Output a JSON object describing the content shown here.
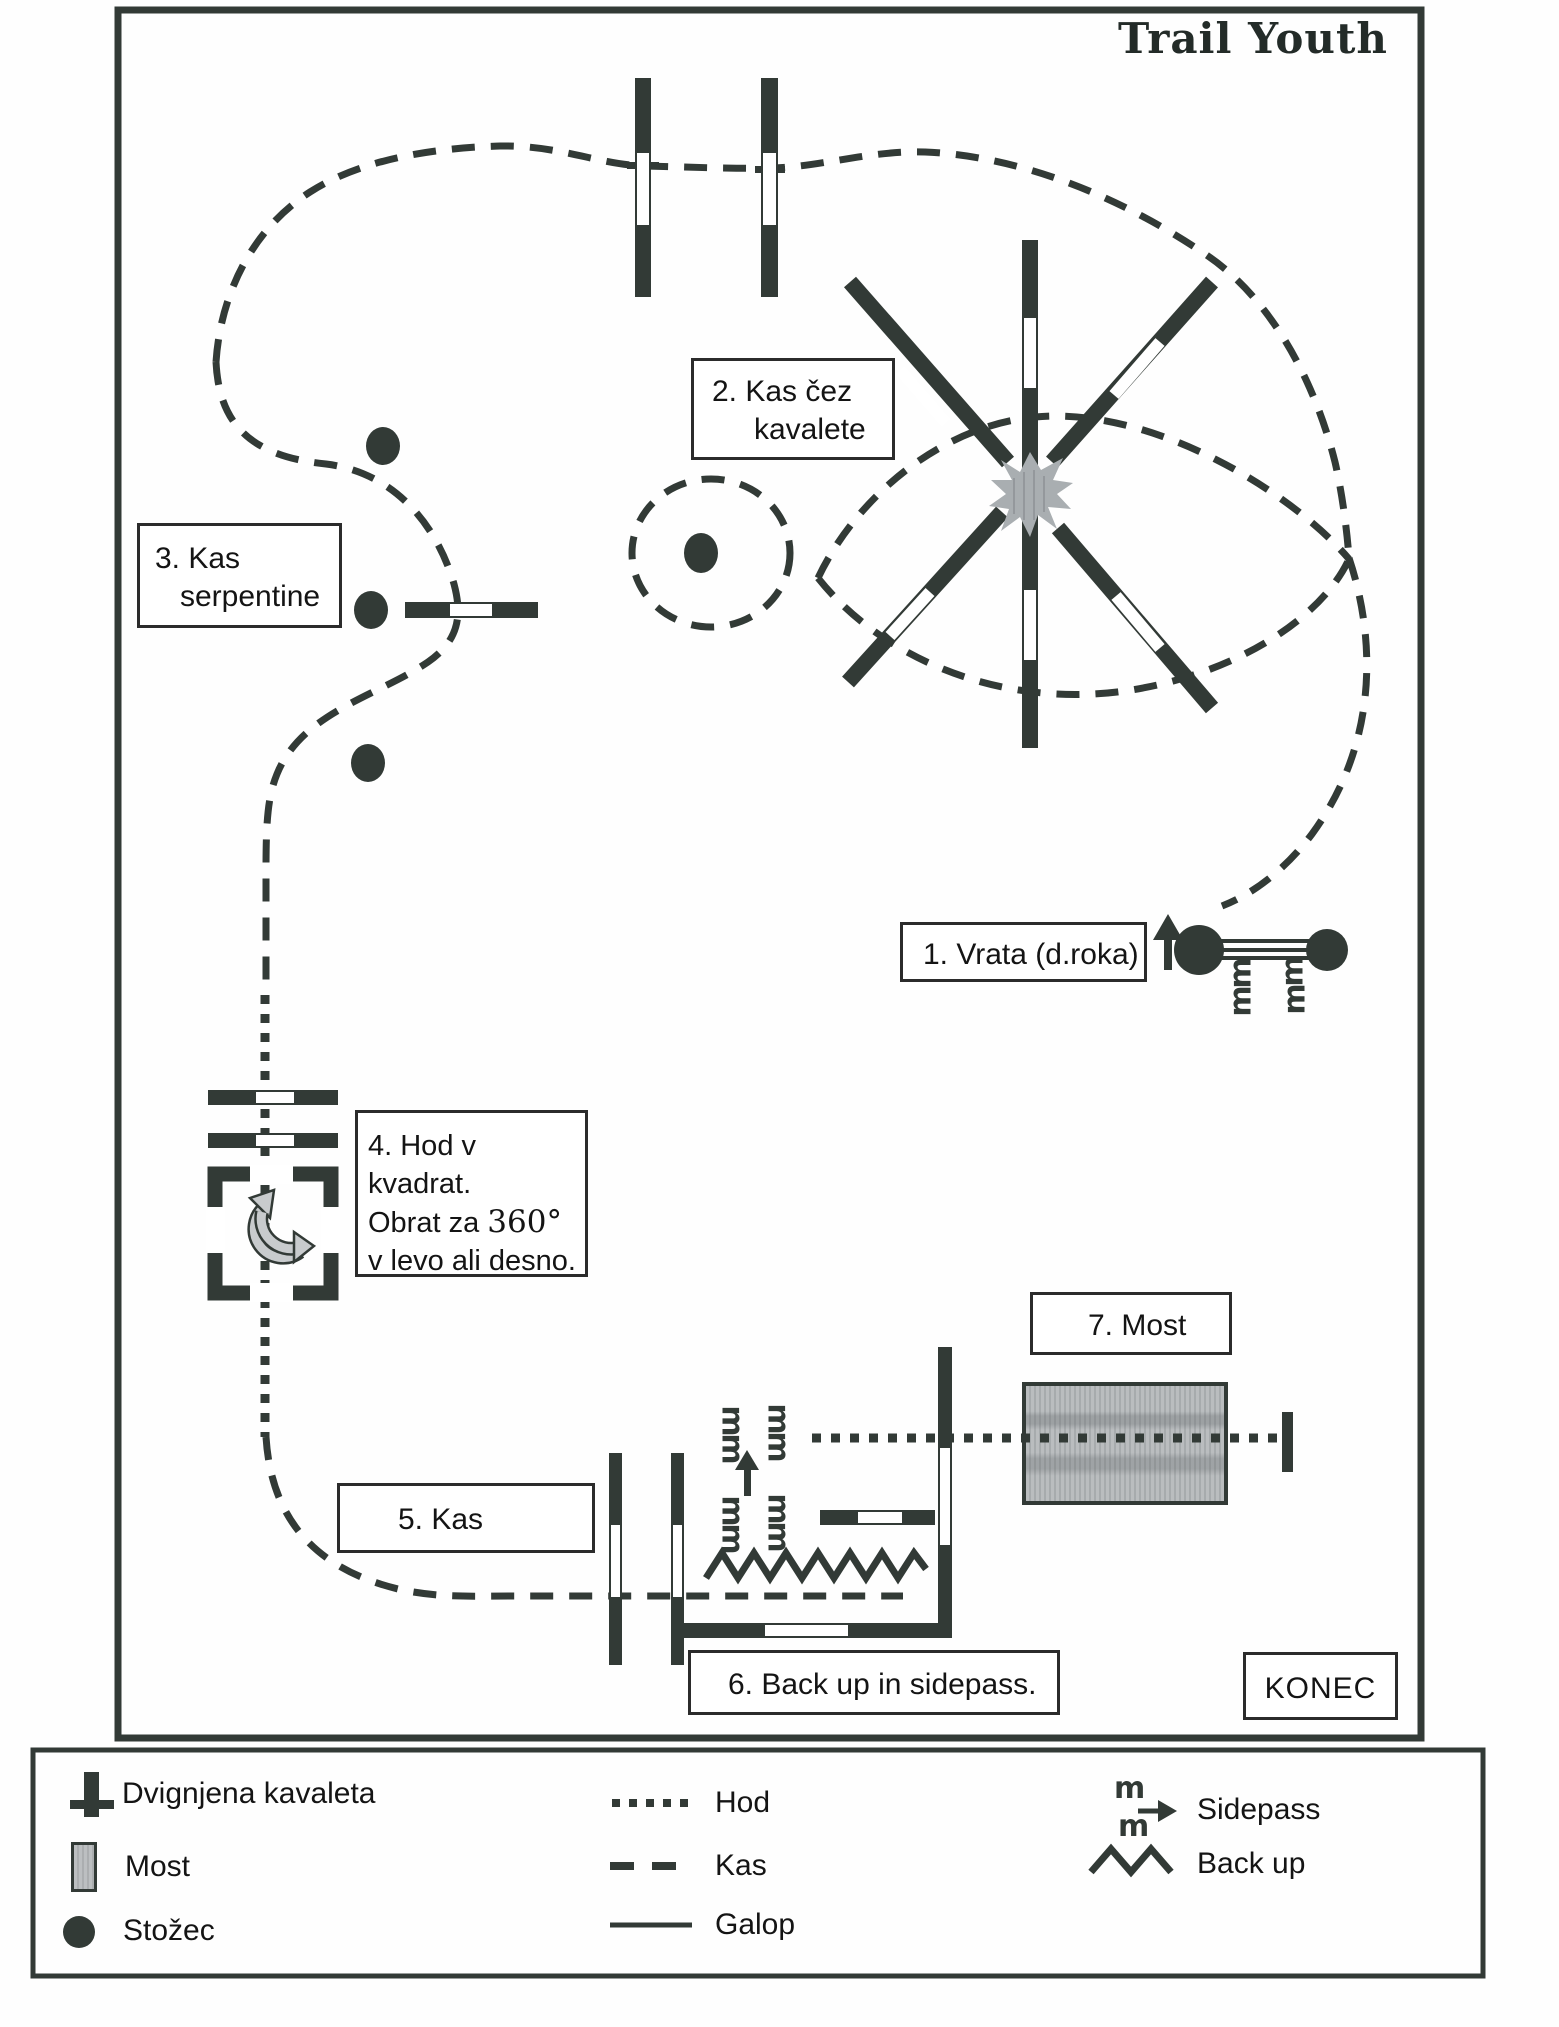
{
  "title": "Trail Youth",
  "labels": {
    "obstacle1": "1. Vrata (d.roka)",
    "obstacle2_line1": "2. Kas čez",
    "obstacle2_line2": "kavalete",
    "obstacle3_line1": "3. Kas",
    "obstacle3_line2": "serpentine",
    "obstacle4_line1": "4. Hod v kvadrat.",
    "obstacle4_line2_prefix": "Obrat za ",
    "obstacle4_line2_degrees": "360°",
    "obstacle4_line3": "v levo ali desno.",
    "obstacle5": "5. Kas",
    "obstacle6": "6. Back up in sidepass.",
    "obstacle7": "7. Most",
    "finish": "KONEC"
  },
  "legend": {
    "raised_cavaletti": "Dvignjena kavaleta",
    "bridge": "Most",
    "cone": "Stožec",
    "walk": "Hod",
    "trot": "Kas",
    "canter": "Galop",
    "sidepass": "Sidepass",
    "backup": "Back up"
  },
  "symbols": {
    "hoofprint": "m"
  },
  "colors": {
    "ink": "#323a36",
    "paper": "#fefefe",
    "bridge_gray": "#b1b4b6",
    "starburst_gray": "#a9aeb1"
  }
}
